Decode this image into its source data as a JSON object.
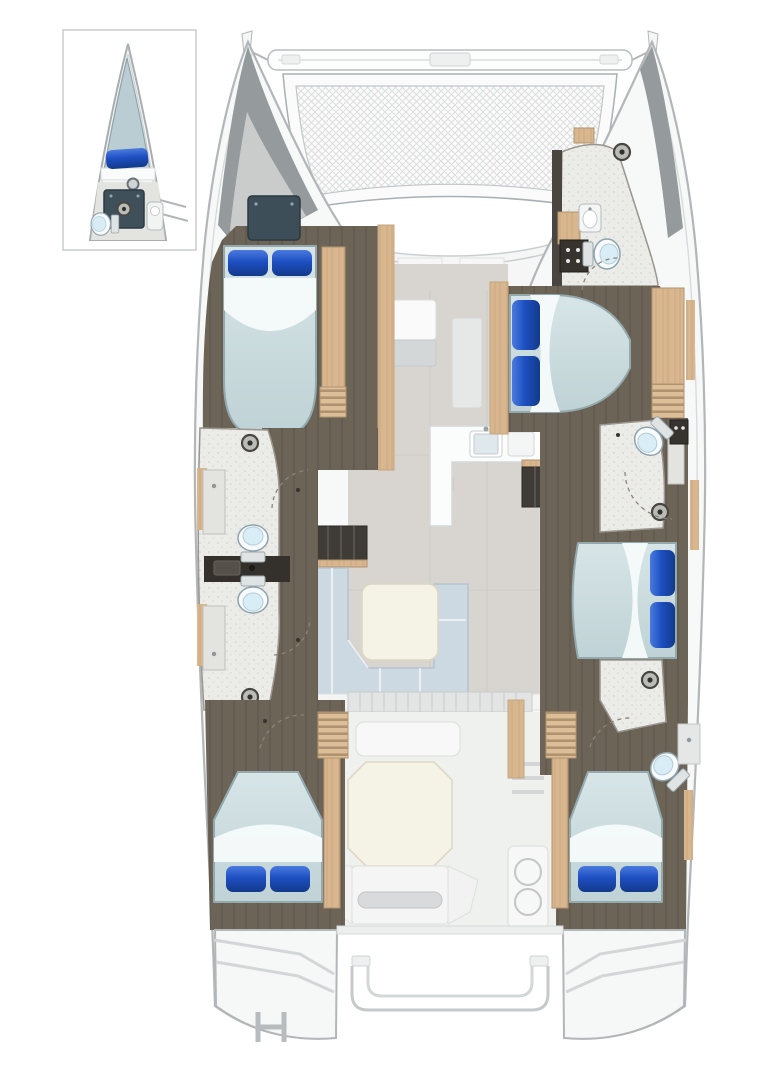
{
  "document": {
    "kind": "catamaran-floor-plan",
    "view": "top-down interior layout, bow at top",
    "width_px": 771,
    "height_px": 1080
  },
  "palette": {
    "background": "#ffffff",
    "hull_fill": "#f7f8f8",
    "hull_line": "#b2b6b9",
    "inner_line": "#d6d9da",
    "deck_fill": "#f5f6f5",
    "deck_line": "#cbced0",
    "trampoline_fill": "#fbfbfb",
    "trampoline_line": "#a9afb2",
    "salon_floor": "#d8d5d0",
    "cockpit_floor": "#eff1ef",
    "cabin_floor": "#6d6458",
    "bath_floor": "#ebece8",
    "bath_trim": "#9a958e",
    "wood": "#d8b68f",
    "wood_dark": "#b2946f",
    "stair_dark": "#3f3b36",
    "mattress_edge": "#93a9ad",
    "sheet": "#f6fafa",
    "pillow_blue": "#1e4fc2",
    "sofa": "#cdd9e2",
    "sofa_line": "#b6c4ce",
    "table_cream": "#f5f2e6",
    "table_line": "#ddd7c2",
    "counter": "#fbfcfc",
    "counter_line": "#d5d8d8",
    "fixture_dark": "#37332e",
    "divider_dark": "#34302b",
    "tv_panel": "#3e4e58",
    "bow_wedge": "#959a9d",
    "bow_wedge_light": "#c9ccca"
  },
  "features": [
    {
      "id": "bow-inset-detail",
      "label": "forepeak V-berth inset with shower box, sink and toilet"
    },
    {
      "id": "trampoline",
      "label": "bow trampoline with crossbeam"
    },
    {
      "id": "port-forward-cabin",
      "label": "port forward double cabin with TV locker and wardrobe"
    },
    {
      "id": "port-midship-heads",
      "label": "port twin heads: two toilets, two vanities, two shower drains"
    },
    {
      "id": "port-aft-cabin",
      "label": "port aft double cabin"
    },
    {
      "id": "starboard-forward-head",
      "label": "starboard forward head: toilet, sink, shower drain"
    },
    {
      "id": "starboard-forward-cabin",
      "label": "starboard forward athwartships double berth"
    },
    {
      "id": "starboard-midship-head",
      "label": "starboard midship head with shower"
    },
    {
      "id": "starboard-midship-cabin",
      "label": "starboard midship double berth"
    },
    {
      "id": "starboard-aft-head",
      "label": "starboard aft head: toilet, sink, shower drain"
    },
    {
      "id": "starboard-aft-cabin",
      "label": "starboard aft double cabin"
    },
    {
      "id": "saloon-forward-lounge",
      "label": "forward saloon lounge seating"
    },
    {
      "id": "galley",
      "label": "galley with sink, cooktop and island column"
    },
    {
      "id": "saloon-dinette",
      "label": "L-shaped dinette sofa with square table"
    },
    {
      "id": "companionway-stairs",
      "label": "louvred companionway steps to each hull"
    },
    {
      "id": "cockpit",
      "label": "aft cockpit with octagonal table, benches and grill module"
    },
    {
      "id": "transom-platforms",
      "label": "twin transom swim platforms with steps"
    },
    {
      "id": "davit-rails",
      "label": "stern davit rails between hulls"
    },
    {
      "id": "swim-ladder",
      "label": "port swim ladder"
    }
  ]
}
